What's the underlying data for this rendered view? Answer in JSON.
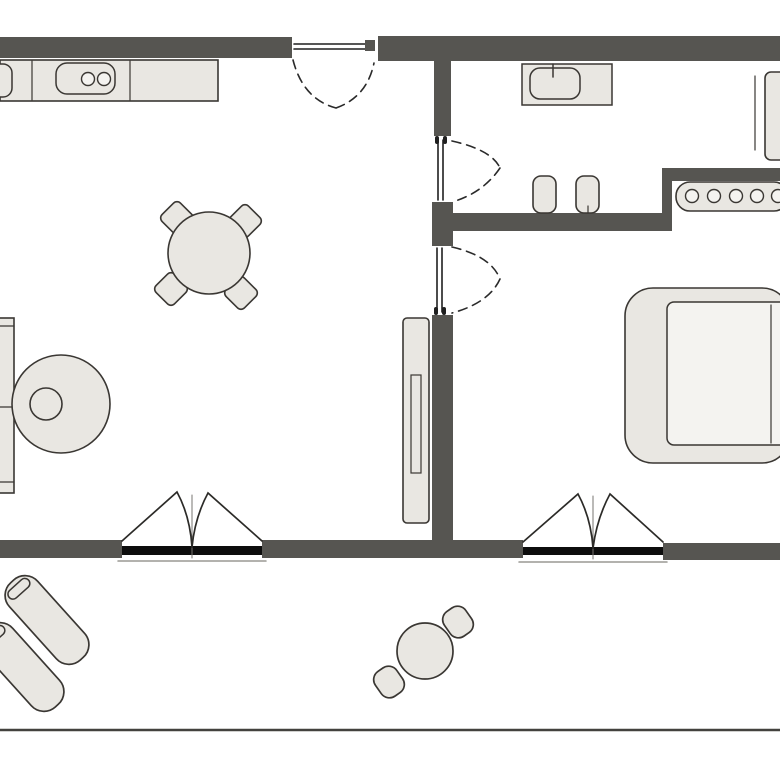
{
  "app": {
    "type": "floor-plan-diagram",
    "description": "Top-down 2D apartment floor plan with living/kitchen area, hallway with bathroom, bedroom and balcony"
  },
  "palette": {
    "background": "#ffffff",
    "wall": "#565551",
    "furniture": "#e9e7e2",
    "furniture_light": "#f4f3f0",
    "outline": "#3a3733",
    "window": "#0d0d0d",
    "door": "#1f1f1f",
    "arc": "#2a2a2a",
    "curtain": "#2c2b28",
    "sill": "#9a9893",
    "thin": "#777470",
    "balcony_edge": "#43423e"
  },
  "floorplan": {
    "width": 780,
    "height": 780,
    "elements": [
      {
        "name": "window-sill-line-left",
        "shape": "line",
        "x1": 118,
        "y1": 561,
        "x2": 266,
        "y2": 561,
        "stroke": "sill",
        "sw": 1.5
      },
      {
        "name": "window-sill-line-right",
        "shape": "line",
        "x1": 519,
        "y1": 562,
        "x2": 667,
        "y2": 562,
        "stroke": "sill",
        "sw": 1.5
      },
      {
        "name": "wall-top-left",
        "shape": "rect",
        "x": 0,
        "y": 37,
        "w": 292,
        "h": 21,
        "fill": "wall"
      },
      {
        "name": "wall-top-right",
        "shape": "rect",
        "x": 378,
        "y": 36,
        "w": 402,
        "h": 25,
        "fill": "wall"
      },
      {
        "name": "wall-divider-upper",
        "shape": "rect",
        "x": 434,
        "y": 57,
        "w": 17,
        "h": 79,
        "fill": "wall"
      },
      {
        "name": "wall-divider-block",
        "shape": "rect",
        "x": 432,
        "y": 202,
        "w": 21,
        "h": 44,
        "fill": "wall"
      },
      {
        "name": "wall-hallway",
        "shape": "rect",
        "x": 432,
        "y": 213,
        "w": 240,
        "h": 18,
        "fill": "wall"
      },
      {
        "name": "wall-hallway-riser",
        "shape": "rect",
        "x": 662,
        "y": 168,
        "w": 10,
        "h": 63,
        "fill": "wall"
      },
      {
        "name": "wall-bedroom-top",
        "shape": "rect",
        "x": 672,
        "y": 168,
        "w": 108,
        "h": 13,
        "fill": "wall"
      },
      {
        "name": "wall-divider-lower",
        "shape": "rect",
        "x": 432,
        "y": 315,
        "w": 21,
        "h": 235,
        "fill": "wall"
      },
      {
        "name": "wall-bottom-left",
        "shape": "rect",
        "x": 0,
        "y": 540,
        "w": 122,
        "h": 18,
        "fill": "wall"
      },
      {
        "name": "wall-bottom-middle",
        "shape": "rect",
        "x": 262,
        "y": 540,
        "w": 261,
        "h": 18,
        "fill": "wall"
      },
      {
        "name": "wall-bottom-right",
        "shape": "rect",
        "x": 663,
        "y": 543,
        "w": 117,
        "h": 17,
        "fill": "wall"
      },
      {
        "name": "window-living-room",
        "shape": "rect",
        "x": 122,
        "y": 546,
        "w": 140,
        "h": 9,
        "fill": "window"
      },
      {
        "name": "window-bedroom",
        "shape": "rect",
        "x": 523,
        "y": 547,
        "w": 140,
        "h": 8,
        "fill": "window"
      },
      {
        "name": "balcony-edge",
        "shape": "line",
        "x1": 0,
        "y1": 730,
        "x2": 780,
        "y2": 730,
        "stroke": "balcony_edge",
        "sw": 2.5
      },
      {
        "name": "kitchen-counter",
        "shape": "rect",
        "x": 0,
        "y": 60,
        "w": 218,
        "h": 41,
        "fill": "furniture",
        "stroke": "outline",
        "sw": 1.6
      },
      {
        "name": "kitchen-counter-divider-1",
        "shape": "line",
        "x1": 32,
        "y1": 61,
        "x2": 32,
        "y2": 100,
        "stroke": "outline",
        "sw": 1.2
      },
      {
        "name": "kitchen-counter-divider-2",
        "shape": "line",
        "x1": 130,
        "y1": 61,
        "x2": 130,
        "y2": 100,
        "stroke": "outline",
        "sw": 1.2
      },
      {
        "name": "kitchen-sink-partial",
        "shape": "rect",
        "x": -30,
        "y": 64,
        "w": 42,
        "h": 33,
        "rx": 9,
        "fill": "furniture",
        "stroke": "outline",
        "sw": 1.5
      },
      {
        "name": "kitchen-cooktop",
        "shape": "rect",
        "x": 56,
        "y": 63,
        "w": 59,
        "h": 31,
        "rx": 11,
        "fill": "furniture",
        "stroke": "outline",
        "sw": 1.5
      },
      {
        "name": "cooktop-burner-1",
        "shape": "circle",
        "cx": 88,
        "cy": 79,
        "r": 6.5,
        "fill": "furniture_light",
        "stroke": "outline",
        "sw": 1.4
      },
      {
        "name": "cooktop-burner-2",
        "shape": "circle",
        "cx": 104,
        "cy": 79,
        "r": 6.5,
        "fill": "furniture_light",
        "stroke": "outline",
        "sw": 1.4
      },
      {
        "name": "dining-chair-nw",
        "shape": "rect",
        "x": -13,
        "y": -13,
        "w": 26,
        "h": 26,
        "rx": 5,
        "transform": "translate(177,218) rotate(45)",
        "fill": "furniture",
        "stroke": "outline",
        "sw": 1.6
      },
      {
        "name": "dining-chair-ne",
        "shape": "rect",
        "x": -13,
        "y": -13,
        "w": 26,
        "h": 26,
        "rx": 5,
        "transform": "translate(245,221) rotate(45)",
        "fill": "furniture",
        "stroke": "outline",
        "sw": 1.6
      },
      {
        "name": "dining-chair-sw",
        "shape": "rect",
        "x": -13,
        "y": -13,
        "w": 26,
        "h": 26,
        "rx": 5,
        "transform": "translate(171,289) rotate(45)",
        "fill": "furniture",
        "stroke": "outline",
        "sw": 1.6
      },
      {
        "name": "dining-chair-se",
        "shape": "rect",
        "x": -13,
        "y": -13,
        "w": 26,
        "h": 26,
        "rx": 5,
        "transform": "translate(241,293) rotate(45)",
        "fill": "furniture",
        "stroke": "outline",
        "sw": 1.6
      },
      {
        "name": "dining-table",
        "shape": "circle",
        "cx": 209,
        "cy": 253,
        "r": 41,
        "fill": "furniture",
        "stroke": "outline",
        "sw": 1.6
      },
      {
        "name": "shelf-unit",
        "shape": "rect",
        "x": -22,
        "y": 318,
        "w": 36,
        "h": 175,
        "fill": "furniture",
        "stroke": "outline",
        "sw": 1.6
      },
      {
        "name": "shelf-divider-1",
        "shape": "line",
        "x1": -22,
        "y1": 326,
        "x2": 14,
        "y2": 326,
        "stroke": "outline",
        "sw": 1.2
      },
      {
        "name": "shelf-divider-2",
        "shape": "line",
        "x1": -22,
        "y1": 407,
        "x2": 14,
        "y2": 407,
        "stroke": "outline",
        "sw": 1.2
      },
      {
        "name": "shelf-divider-3",
        "shape": "line",
        "x1": -22,
        "y1": 482,
        "x2": 14,
        "y2": 482,
        "stroke": "outline",
        "sw": 1.2
      },
      {
        "name": "round-lounge-chair",
        "shape": "circle",
        "cx": 61,
        "cy": 404,
        "r": 49,
        "fill": "furniture",
        "stroke": "outline",
        "sw": 1.6
      },
      {
        "name": "round-lounge-chair-cushion",
        "shape": "circle",
        "cx": 46,
        "cy": 404,
        "r": 16,
        "fill": "furniture",
        "stroke": "outline",
        "sw": 1.6
      },
      {
        "name": "wardrobe",
        "shape": "rect",
        "x": 403,
        "y": 318,
        "w": 26,
        "h": 205,
        "rx": 4,
        "fill": "furniture",
        "stroke": "outline",
        "sw": 1.6
      },
      {
        "name": "wardrobe-handle",
        "shape": "rect",
        "x": 411,
        "y": 375,
        "w": 10,
        "h": 98,
        "fill": "none",
        "stroke": "outline",
        "sw": 1.2
      },
      {
        "name": "bed-frame",
        "shape": "rect",
        "x": 625,
        "y": 288,
        "w": 165,
        "h": 175,
        "rx": 28,
        "fill": "furniture",
        "stroke": "outline",
        "sw": 1.6
      },
      {
        "name": "bed-mattress",
        "shape": "rect",
        "x": 667,
        "y": 302,
        "w": 123,
        "h": 143,
        "rx": 7,
        "fill": "furniture_light",
        "stroke": "outline",
        "sw": 1.5
      },
      {
        "name": "bed-blanket-fold",
        "shape": "line",
        "x1": 771,
        "y1": 305,
        "x2": 771,
        "y2": 443,
        "stroke": "outline",
        "sw": 1.2
      },
      {
        "name": "radiator",
        "shape": "rect",
        "x": 676,
        "y": 182,
        "w": 112,
        "h": 29,
        "rx": 14,
        "fill": "furniture",
        "stroke": "outline",
        "sw": 1.6
      },
      {
        "name": "radiator-circle-1",
        "shape": "circle",
        "cx": 692,
        "cy": 196,
        "r": 6.5,
        "fill": "furniture_light",
        "stroke": "outline",
        "sw": 1.4
      },
      {
        "name": "radiator-circle-2",
        "shape": "circle",
        "cx": 714,
        "cy": 196,
        "r": 6.5,
        "fill": "furniture_light",
        "stroke": "outline",
        "sw": 1.4
      },
      {
        "name": "radiator-circle-3",
        "shape": "circle",
        "cx": 736,
        "cy": 196,
        "r": 6.5,
        "fill": "furniture_light",
        "stroke": "outline",
        "sw": 1.4
      },
      {
        "name": "radiator-circle-4",
        "shape": "circle",
        "cx": 757,
        "cy": 196,
        "r": 6.5,
        "fill": "furniture_light",
        "stroke": "outline",
        "sw": 1.4
      },
      {
        "name": "radiator-circle-5",
        "shape": "circle",
        "cx": 778,
        "cy": 196,
        "r": 6.5,
        "fill": "furniture_light",
        "stroke": "outline",
        "sw": 1.4
      },
      {
        "name": "bathroom-counter",
        "shape": "rect",
        "x": 522,
        "y": 64,
        "w": 90,
        "h": 41,
        "fill": "furniture",
        "stroke": "outline",
        "sw": 1.5
      },
      {
        "name": "bathroom-sink",
        "shape": "rect",
        "x": 530,
        "y": 68,
        "w": 50,
        "h": 31,
        "rx": 10,
        "fill": "furniture",
        "stroke": "outline",
        "sw": 1.5
      },
      {
        "name": "bathroom-tap",
        "shape": "line",
        "x1": 553,
        "y1": 64,
        "x2": 553,
        "y2": 77,
        "stroke": "outline",
        "sw": 1.5
      },
      {
        "name": "bathroom-cabinet-door-line",
        "shape": "line",
        "x1": 755,
        "y1": 76,
        "x2": 755,
        "y2": 150,
        "stroke": "outline",
        "sw": 1.2
      },
      {
        "name": "bathroom-cabinet",
        "shape": "rect",
        "x": 765,
        "y": 72,
        "w": 30,
        "h": 88,
        "rx": 6,
        "fill": "furniture",
        "stroke": "outline",
        "sw": 1.6
      },
      {
        "name": "hallway-stool-1",
        "shape": "rect",
        "x": 533,
        "y": 176,
        "w": 23,
        "h": 37,
        "rx": 8,
        "fill": "furniture",
        "stroke": "outline",
        "sw": 1.6
      },
      {
        "name": "hallway-stool-2",
        "shape": "rect",
        "x": 576,
        "y": 176,
        "w": 23,
        "h": 37,
        "rx": 8,
        "fill": "furniture",
        "stroke": "outline",
        "sw": 1.6
      },
      {
        "name": "hallway-stool-2-mark",
        "shape": "line",
        "x1": 588,
        "y1": 206,
        "x2": 588,
        "y2": 213,
        "stroke": "outline",
        "sw": 1.2
      },
      {
        "name": "sun-lounger-1",
        "shape": "rect",
        "x": -19,
        "y": -52,
        "w": 38,
        "h": 104,
        "rx": 17,
        "transform": "translate(47,620) rotate(-42)",
        "fill": "furniture",
        "stroke": "outline",
        "sw": 1.7
      },
      {
        "name": "sun-lounger-1-pillow",
        "shape": "rect",
        "x": -13,
        "y": -47,
        "w": 26,
        "h": 10,
        "rx": 5,
        "transform": "translate(47,620) rotate(-42)",
        "fill": "furniture",
        "stroke": "outline",
        "sw": 1.5
      },
      {
        "name": "sun-lounger-2",
        "shape": "rect",
        "x": -19,
        "y": -52,
        "w": 38,
        "h": 104,
        "rx": 17,
        "transform": "translate(22,667) rotate(-42)",
        "fill": "furniture",
        "stroke": "outline",
        "sw": 1.7
      },
      {
        "name": "sun-lounger-2-pillow",
        "shape": "rect",
        "x": -13,
        "y": -47,
        "w": 26,
        "h": 10,
        "rx": 5,
        "transform": "translate(22,667) rotate(-42)",
        "fill": "furniture",
        "stroke": "outline",
        "sw": 1.5
      },
      {
        "name": "balcony-table",
        "shape": "circle",
        "cx": 425,
        "cy": 651,
        "r": 28,
        "fill": "furniture",
        "stroke": "outline",
        "sw": 1.7
      },
      {
        "name": "balcony-stool-1",
        "shape": "rect",
        "x": -13,
        "y": -15,
        "w": 26,
        "h": 30,
        "rx": 10,
        "transform": "translate(458,622) rotate(-35)",
        "fill": "furniture",
        "stroke": "outline",
        "sw": 1.7
      },
      {
        "name": "balcony-stool-2",
        "shape": "rect",
        "x": -13,
        "y": -15,
        "w": 26,
        "h": 30,
        "rx": 10,
        "transform": "translate(389,682) rotate(-35)",
        "fill": "furniture",
        "stroke": "outline",
        "sw": 1.7
      },
      {
        "name": "entry-door-leaf-line-1",
        "shape": "line",
        "x1": 294,
        "y1": 44,
        "x2": 371,
        "y2": 44,
        "stroke": "door",
        "sw": 1.6
      },
      {
        "name": "entry-door-leaf-line-2",
        "shape": "line",
        "x1": 294,
        "y1": 49,
        "x2": 371,
        "y2": 49,
        "stroke": "door",
        "sw": 1.6
      },
      {
        "name": "entry-door-hinge",
        "shape": "rect",
        "x": 365,
        "y": 40,
        "w": 10,
        "h": 11,
        "fill": "wall"
      },
      {
        "name": "entry-door-swing-arc",
        "shape": "path",
        "d": "M293 60 Q303 99 336 108 M336 108 Q367 97 374 63",
        "fill": "none",
        "stroke": "arc",
        "sw": 1.6,
        "dash": "9 6"
      },
      {
        "name": "bathroom-door-leaf-line-1",
        "shape": "line",
        "x1": 438,
        "y1": 140,
        "x2": 438,
        "y2": 200,
        "stroke": "door",
        "sw": 1.6
      },
      {
        "name": "bathroom-door-leaf-line-2",
        "shape": "line",
        "x1": 443,
        "y1": 140,
        "x2": 443,
        "y2": 200,
        "stroke": "door",
        "sw": 1.6
      },
      {
        "name": "bathroom-door-hinge-1",
        "shape": "rect",
        "x": 435,
        "y": 136,
        "w": 4,
        "h": 8,
        "rx": 2,
        "fill": "door"
      },
      {
        "name": "bathroom-door-hinge-2",
        "shape": "rect",
        "x": 443,
        "y": 136,
        "w": 4,
        "h": 8,
        "rx": 2,
        "fill": "door"
      },
      {
        "name": "bathroom-door-swing-arc",
        "shape": "path",
        "d": "M452 141 Q492 150 500 168 M500 168 Q483 193 452 202",
        "fill": "none",
        "stroke": "arc",
        "sw": 1.6,
        "dash": "9 6"
      },
      {
        "name": "bedroom-door-leaf-line-1",
        "shape": "line",
        "x1": 437,
        "y1": 248,
        "x2": 437,
        "y2": 312,
        "stroke": "door",
        "sw": 1.6
      },
      {
        "name": "bedroom-door-leaf-line-2",
        "shape": "line",
        "x1": 442,
        "y1": 248,
        "x2": 442,
        "y2": 312,
        "stroke": "door",
        "sw": 1.6
      },
      {
        "name": "bedroom-door-hinge-1",
        "shape": "rect",
        "x": 434,
        "y": 307,
        "w": 4,
        "h": 8,
        "rx": 2,
        "fill": "door"
      },
      {
        "name": "bedroom-door-hinge-2",
        "shape": "rect",
        "x": 442,
        "y": 307,
        "w": 4,
        "h": 8,
        "rx": 2,
        "fill": "door"
      },
      {
        "name": "bedroom-door-swing-arc",
        "shape": "path",
        "d": "M452 247 Q491 256 500 279 M500 279 Q489 303 452 313",
        "fill": "none",
        "stroke": "arc",
        "sw": 1.6,
        "dash": "9 6"
      },
      {
        "name": "curtain-left-center-line",
        "shape": "line",
        "x1": 192,
        "y1": 495,
        "x2": 192,
        "y2": 558,
        "stroke": "thin",
        "sw": 1
      },
      {
        "name": "curtain-symbol-left",
        "shape": "path",
        "d": "M122 541 L177 492 Q190 516 192 547 M262 541 L208 493 Q195 517 192 547",
        "fill": "none",
        "stroke": "curtain",
        "sw": 1.7
      },
      {
        "name": "curtain-right-center-line",
        "shape": "line",
        "x1": 593,
        "y1": 496,
        "x2": 593,
        "y2": 559,
        "stroke": "thin",
        "sw": 1
      },
      {
        "name": "curtain-symbol-right",
        "shape": "path",
        "d": "M523 542 L578 494 Q591 518 593 548 M663 542 L610 494 Q597 518 593 548",
        "fill": "none",
        "stroke": "curtain",
        "sw": 1.7
      }
    ]
  }
}
